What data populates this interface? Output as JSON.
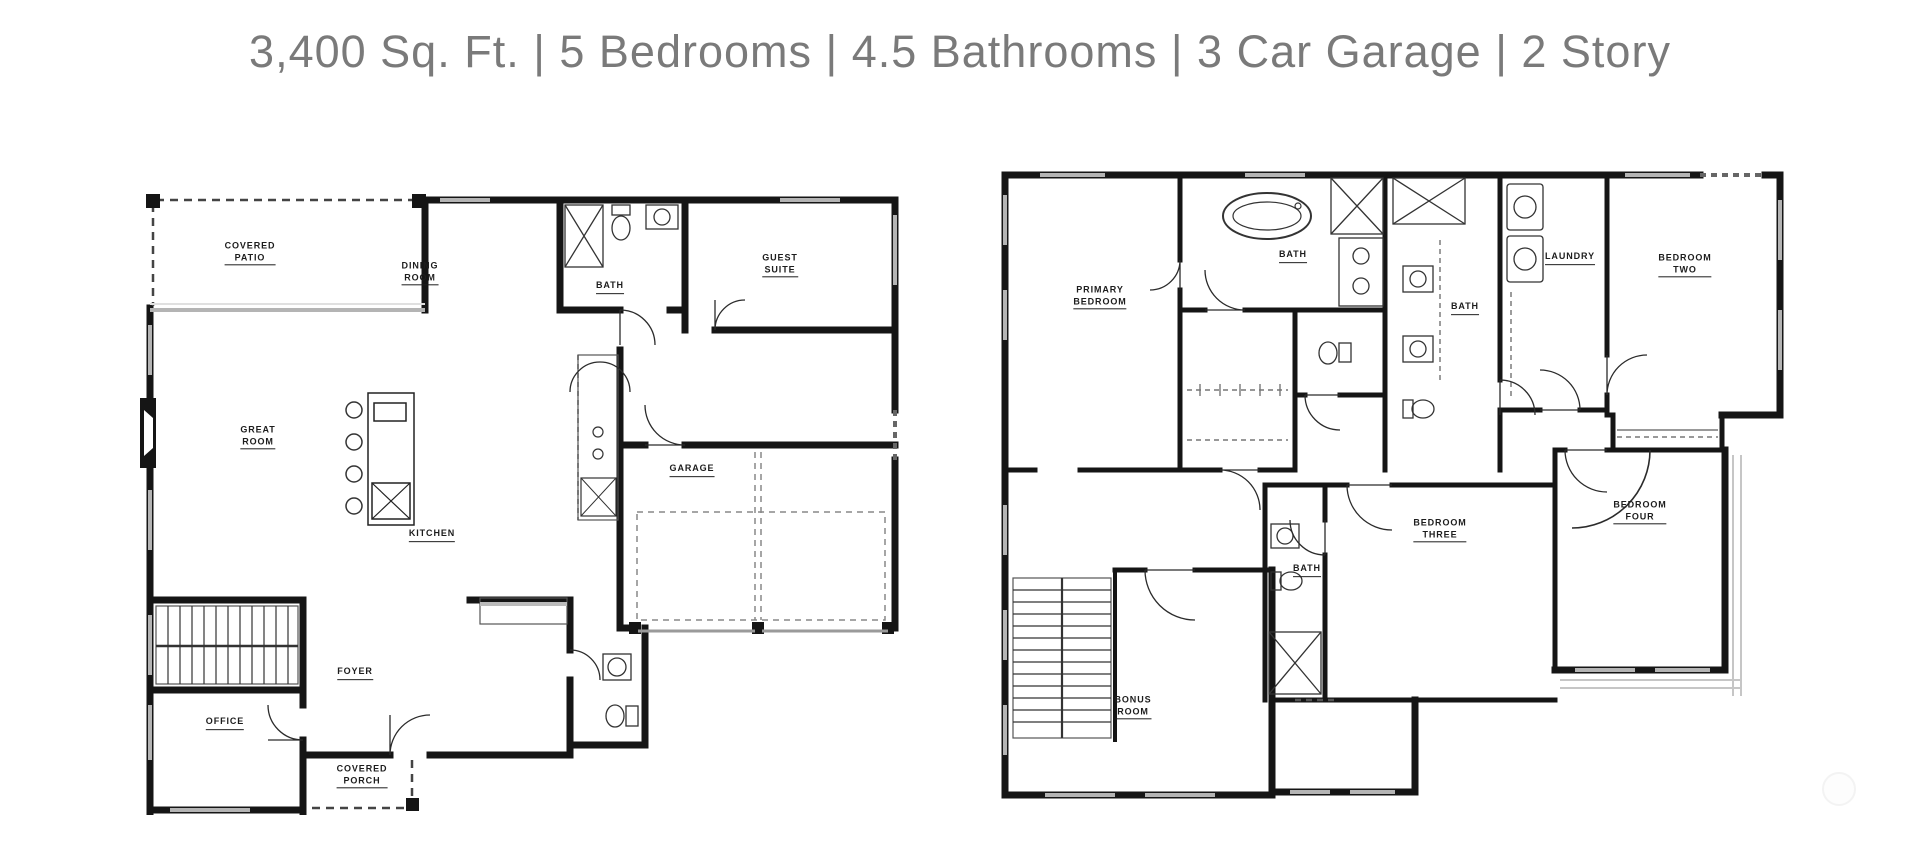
{
  "header": {
    "title": "3,400 Sq. Ft. | 5 Bedrooms | 4.5 Bathrooms | 3 Car Garage | 2 Story",
    "segments": [
      "3,400 Sq. Ft.",
      "5 Bedrooms",
      "4.5 Bathrooms",
      "3 Car Garage",
      "2 Story"
    ],
    "text_color": "#7a7a7a"
  },
  "colors": {
    "background": "#ffffff",
    "walls": "#151515",
    "label_text": "#1d1d1d",
    "window_lines": "#b4b4b4",
    "dashed_lines": "#666666"
  },
  "floor1": {
    "rooms": [
      {
        "id": "covered-patio",
        "label": "COVERED\nPATIO"
      },
      {
        "id": "dining-room",
        "label": "DINING\nROOM"
      },
      {
        "id": "bath",
        "label": "BATH"
      },
      {
        "id": "guest-suite",
        "label": "GUEST\nSUITE"
      },
      {
        "id": "great-room",
        "label": "GREAT\nROOM"
      },
      {
        "id": "kitchen",
        "label": "KITCHEN"
      },
      {
        "id": "garage",
        "label": "GARAGE"
      },
      {
        "id": "foyer",
        "label": "FOYER"
      },
      {
        "id": "office",
        "label": "OFFICE"
      },
      {
        "id": "covered-porch",
        "label": "COVERED\nPORCH"
      }
    ]
  },
  "floor2": {
    "rooms": [
      {
        "id": "primary-bedroom",
        "label": "PRIMARY\nBEDROOM"
      },
      {
        "id": "primary-bath",
        "label": "BATH"
      },
      {
        "id": "laundry",
        "label": "LAUNDRY"
      },
      {
        "id": "bedroom-two",
        "label": "BEDROOM\nTWO"
      },
      {
        "id": "hall-bath",
        "label": "BATH"
      },
      {
        "id": "bedroom-three",
        "label": "BEDROOM\nTHREE"
      },
      {
        "id": "bedroom-four",
        "label": "BEDROOM\nFOUR"
      },
      {
        "id": "bath-three",
        "label": "BATH"
      },
      {
        "id": "bonus-room",
        "label": "BONUS\nROOM"
      }
    ]
  }
}
